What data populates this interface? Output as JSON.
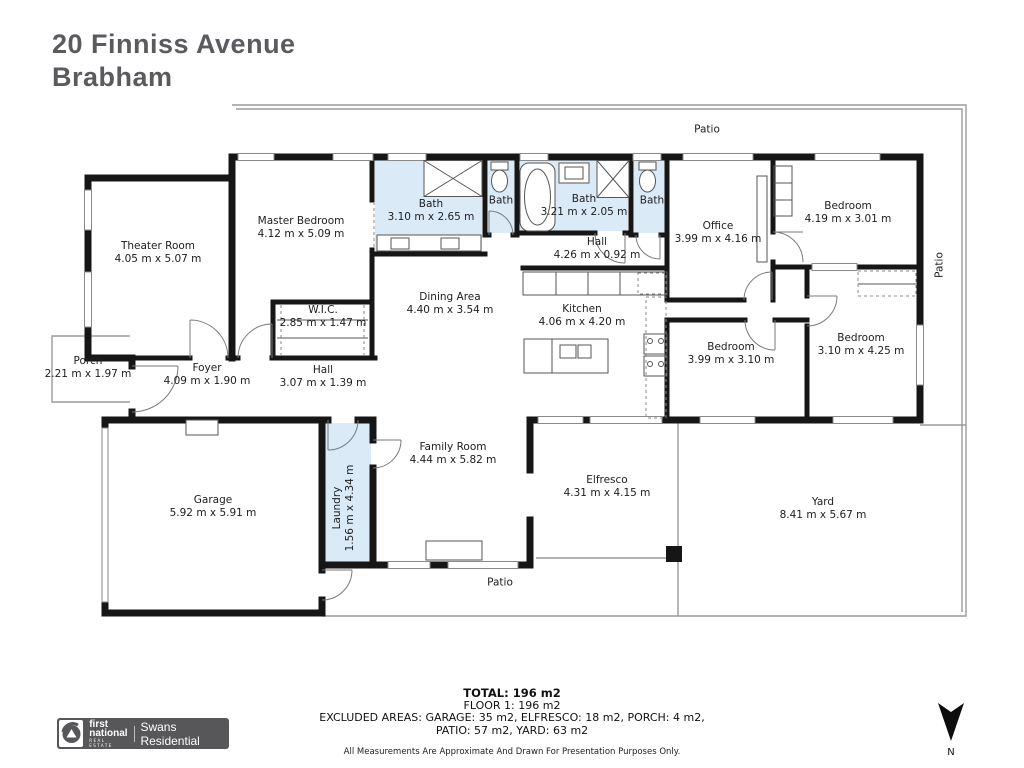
{
  "header": {
    "address_line1": "20 Finniss Avenue",
    "address_line2": "Brabham"
  },
  "plan": {
    "rooms": [
      {
        "id": "theater-room",
        "name": "Theater Room",
        "dims": "4.05 m x 5.07 m"
      },
      {
        "id": "master-bedroom",
        "name": "Master Bedroom",
        "dims": "4.12 m x 5.09 m"
      },
      {
        "id": "wic",
        "name": "W.I.C.",
        "dims": "2.85 m x 1.47 m"
      },
      {
        "id": "bath-ensuite",
        "name": "Bath",
        "dims": "3.10 m x 2.65 m"
      },
      {
        "id": "bath-wc-1",
        "name": "Bath",
        "dims": ""
      },
      {
        "id": "bath-main",
        "name": "Bath",
        "dims": "3.21 m x 2.05 m"
      },
      {
        "id": "bath-wc-2",
        "name": "Bath",
        "dims": ""
      },
      {
        "id": "hall-upper",
        "name": "Hall",
        "dims": "4.26 m x 0.92 m"
      },
      {
        "id": "office",
        "name": "Office",
        "dims": "3.99 m x 4.16 m"
      },
      {
        "id": "bedroom-2",
        "name": "Bedroom",
        "dims": "4.19 m x 3.01 m"
      },
      {
        "id": "bedroom-3",
        "name": "Bedroom",
        "dims": "3.99 m x 3.10 m"
      },
      {
        "id": "bedroom-4",
        "name": "Bedroom",
        "dims": "3.10 m x 4.25 m"
      },
      {
        "id": "dining-area",
        "name": "Dining Area",
        "dims": "4.40 m x 3.54 m"
      },
      {
        "id": "kitchen",
        "name": "Kitchen",
        "dims": "4.06 m x 4.20 m"
      },
      {
        "id": "porch",
        "name": "Porch",
        "dims": "2.21 m x 1.97 m"
      },
      {
        "id": "foyer",
        "name": "Foyer",
        "dims": "4.09 m x 1.90 m"
      },
      {
        "id": "hall-lower",
        "name": "Hall",
        "dims": "3.07 m x 1.39 m"
      },
      {
        "id": "garage",
        "name": "Garage",
        "dims": "5.92 m x 5.91 m"
      },
      {
        "id": "laundry",
        "name": "Laundry",
        "dims": "1.56 m x 4.34 m"
      },
      {
        "id": "family-room",
        "name": "Family Room",
        "dims": "4.44 m x 5.82 m"
      },
      {
        "id": "elfresco",
        "name": "Elfresco",
        "dims": "4.31 m x 4.15 m"
      },
      {
        "id": "yard",
        "name": "Yard",
        "dims": "8.41 m x 5.67 m"
      },
      {
        "id": "patio-top",
        "name": "Patio",
        "dims": ""
      },
      {
        "id": "patio-right",
        "name": "Patio",
        "dims": ""
      },
      {
        "id": "patio-bottom",
        "name": "Patio",
        "dims": ""
      }
    ]
  },
  "footer": {
    "total": "TOTAL: 196 m2",
    "floor": "FLOOR 1: 196 m2",
    "excluded_line1": "EXCLUDED AREAS: GARAGE: 35 m2, ELFRESCO: 18 m2, PORCH: 4 m2,",
    "excluded_line2": "PATIO: 57 m2, YARD: 63 m2",
    "disclaimer": "All Measurements Are Approximate And Drawn For Presentation Purposes Only.",
    "compass_label": "N"
  },
  "logo": {
    "brand_line1": "first",
    "brand_line2": "national",
    "brand_sub": "REAL ESTATE",
    "agency": "Swans Residential"
  },
  "colors": {
    "wall": "#161616",
    "wet_area": "#daeaf7",
    "title_text": "#5a5b5e",
    "logo_bar": "#57575a",
    "outdoor_line": "#9a9a9a"
  }
}
